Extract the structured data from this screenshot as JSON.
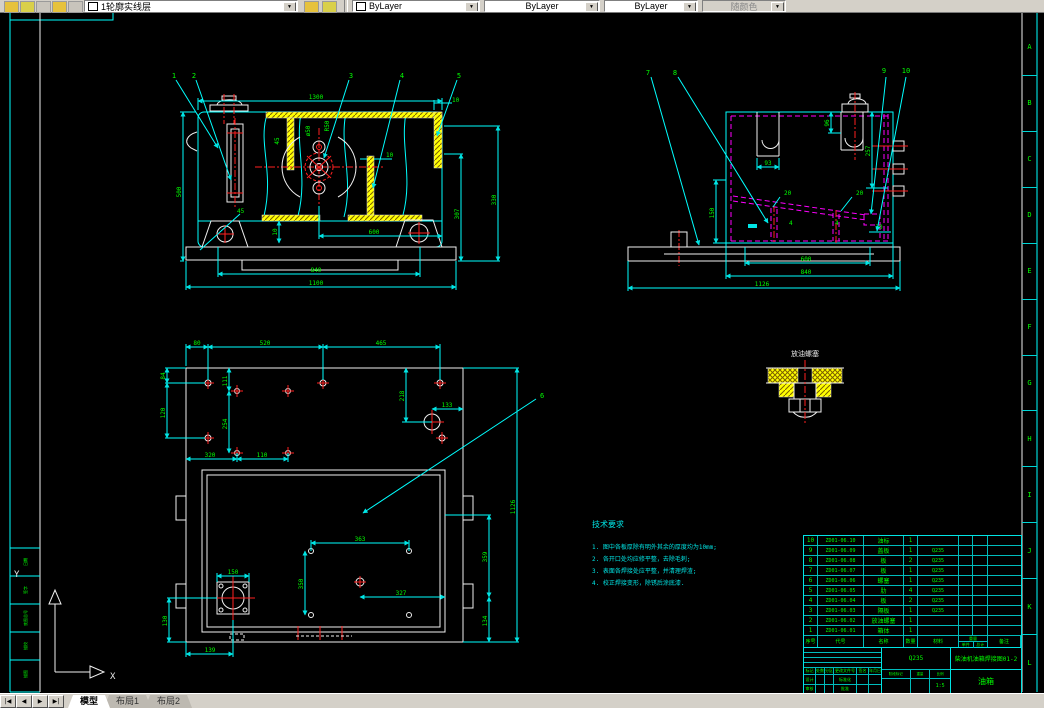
{
  "toolbar": {
    "layer": "1轮廓实线层",
    "color": "ByLayer",
    "ltype": "ByLayer",
    "lweight": "ByLayer",
    "pstyle": "随颜色"
  },
  "icons": {
    "chevron": "▼"
  },
  "tabbar": {
    "nav1": "|◀",
    "nav2": "◀",
    "nav3": "▶",
    "nav4": "▶|",
    "tabs": [
      {
        "label": "模型"
      },
      {
        "label": "布局1"
      },
      {
        "label": "布局2"
      }
    ]
  },
  "zones": [
    "A",
    "B",
    "C",
    "D",
    "E",
    "F",
    "G",
    "H",
    "I",
    "J",
    "K",
    "L"
  ],
  "strip": {
    "s1": "日期",
    "s2": "签字",
    "s3": "底图总号",
    "s4": "描校",
    "s5": "描图"
  },
  "ucs": {
    "x": "X",
    "y": "Y"
  },
  "front": {
    "b1": "1",
    "b2": "2",
    "b3": "3",
    "b4": "4",
    "b5": "5",
    "d1300": "1300",
    "d500": "500",
    "d330": "330",
    "d307": "307",
    "d10a": "10",
    "d10m": "10",
    "d45a": "45",
    "dphi": "ø50",
    "dr50": "R50",
    "d45b": "45",
    "d10b": "10",
    "d600": "600",
    "d840": "840",
    "d1100": "1100"
  },
  "side": {
    "b7": "7",
    "b8": "8",
    "b9": "9",
    "b10": "10",
    "d96": "96",
    "d257": "257",
    "d93": "93",
    "d150": "150",
    "d20a": "20",
    "d20b": "20",
    "d30": "30",
    "w4a": "4",
    "w4b": "4",
    "d600": "600",
    "d840": "840",
    "d1126": "1126"
  },
  "plan": {
    "b6": "6",
    "d80": "80",
    "d520": "520",
    "d465": "465",
    "d84": "84",
    "d120": "120",
    "d111": "111",
    "d254": "254",
    "d218": "218",
    "d133": "133",
    "d320": "320",
    "d110": "110",
    "d1126": "1126",
    "d363": "363",
    "d350": "350",
    "d327": "327",
    "d359": "359",
    "d134": "134",
    "d150": "150",
    "d130": "130",
    "d139": "139"
  },
  "detail": {
    "title": "放油螺塞"
  },
  "notes": {
    "title": "技术要求",
    "l1": "1. 图中各板厚除有明外其余的厚度均为10mm;",
    "l2": "2. 各开口处均应修平整，去除毛刺;",
    "l3": "3. 表面各焊接处应平整，并清理焊渣;",
    "l4": "4. 校正焊接变形，除锈后涂底漆."
  },
  "bom": {
    "headers": {
      "no": "序号",
      "code": "代号",
      "name": "名称",
      "qty": "数量",
      "mat": "材料",
      "wt": "重量",
      "unit": "单件",
      "total": "总计",
      "rem": "备注"
    },
    "rows": [
      {
        "n": "10",
        "c": "ZD01-06.10",
        "m": "油标",
        "q": "1",
        "t": ""
      },
      {
        "n": "9",
        "c": "ZD01-06.09",
        "m": "盖板",
        "q": "1",
        "t": "Q235"
      },
      {
        "n": "8",
        "c": "ZD01-06.08",
        "m": "板",
        "q": "2",
        "t": "Q235"
      },
      {
        "n": "7",
        "c": "ZD01-06.07",
        "m": "板",
        "q": "1",
        "t": "Q235"
      },
      {
        "n": "6",
        "c": "ZD01-06.06",
        "m": "螺塞",
        "q": "1",
        "t": "Q235"
      },
      {
        "n": "5",
        "c": "ZD01-06.05",
        "m": "肋",
        "q": "4",
        "t": "Q235"
      },
      {
        "n": "4",
        "c": "ZD01-06.04",
        "m": "板",
        "q": "2",
        "t": "Q235"
      },
      {
        "n": "3",
        "c": "ZD01-06.03",
        "m": "隔板",
        "q": "1",
        "t": "Q235"
      },
      {
        "n": "2",
        "c": "ZD01-06.02",
        "m": "放油螺塞",
        "q": "1",
        "t": ""
      },
      {
        "n": "1",
        "c": "ZD01-06.01",
        "m": "箱体",
        "q": "1",
        "t": ""
      }
    ]
  },
  "tb": {
    "mark": "标记",
    "count": "处数",
    "zone": "分区",
    "doc": "更改文件号",
    "sign": "签名",
    "date": "年月日",
    "design": "设计",
    "std": "标准化",
    "audit": "审核",
    "appr": "批准",
    "stage": "阶段标记",
    "weight": "重量",
    "scale": "比例",
    "scale_val": "1:5",
    "mat": "Q235",
    "no": "柴油机油箱焊接图01-2",
    "name": "油箱"
  }
}
